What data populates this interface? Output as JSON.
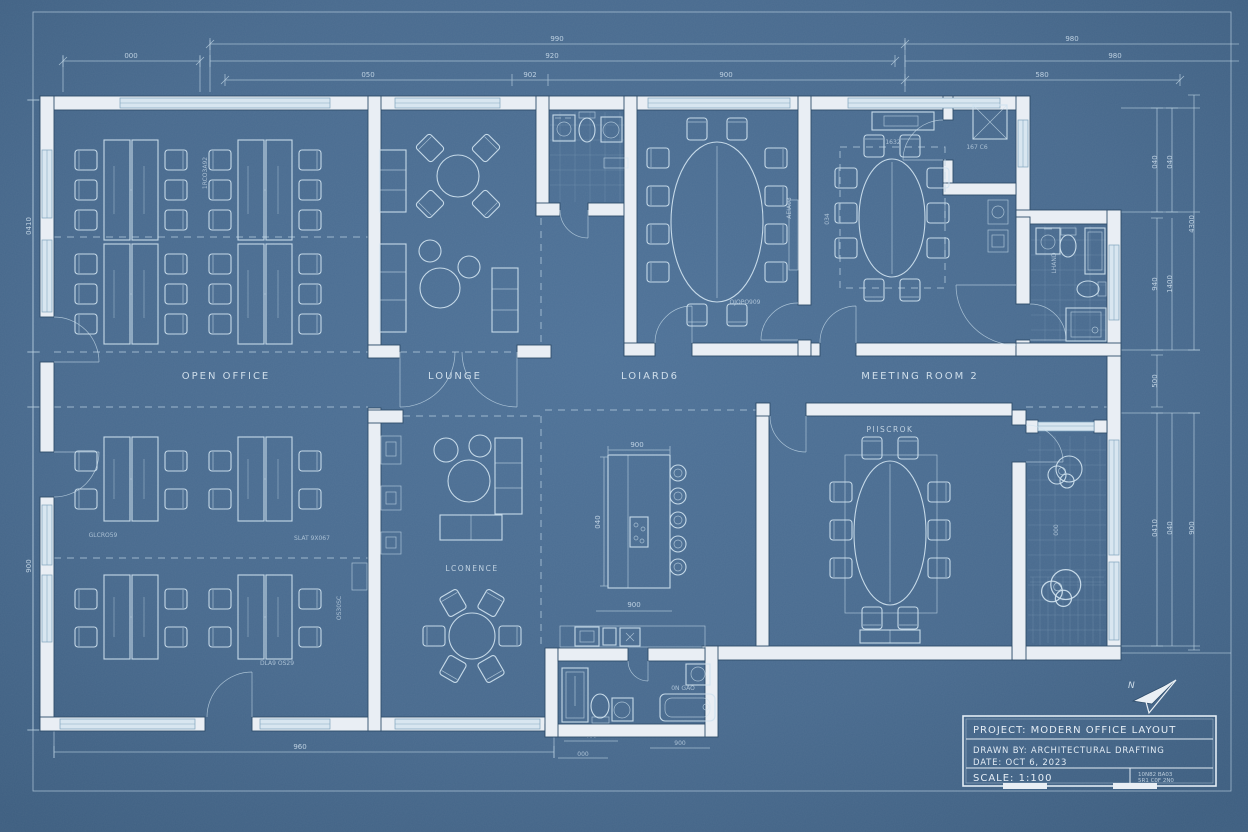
{
  "colors": {
    "background": "#486a8e",
    "wall": "#e9eef4",
    "line": "#cfe2ef",
    "dimension": "#b9d0e0",
    "window": "#d8e6f0",
    "text": "#dce9f3",
    "wall_outline": "#2f4d6b"
  },
  "rooms": {
    "open_office": "OPEN OFFICE",
    "lounge": "LOUNGE",
    "boardroom": "LOIARD6",
    "meeting_room_2": "MEETING ROOM 2",
    "meeting_room_3": "PIISCROK",
    "conference": "LCONENCE"
  },
  "title_block": {
    "project": "PROJECT: MODERN OFFICE LAYOUT",
    "drawn_by": "DRAWN BY: ARCHITECTURAL DRAFTING",
    "date": "DATE: OCT 6, 2023",
    "scale": "SCALE: 1:100",
    "stamp_line1": "10N82 BA03",
    "stamp_line2": "5R1 C0F 2N0"
  },
  "north_label": "N",
  "dims_top": [
    "990",
    "980",
    "000",
    "920",
    "980",
    "050",
    "902",
    "900",
    "580"
  ],
  "dims_right": [
    "040",
    "040",
    "4300",
    "940",
    "1400",
    "500",
    "0410",
    "040",
    "900"
  ],
  "dims_left": [
    "0410",
    "900"
  ],
  "dims_bottom": [
    "960",
    "400",
    "900",
    "000"
  ],
  "dims_inner": [
    "900",
    "900",
    "040",
    "1632",
    "034"
  ],
  "tags": [
    "GLCRO59",
    "SLAT 9X067",
    "DLA9 OS29",
    "OS30SC",
    "1RCO3A92",
    "OJOPO909",
    "AEIA03",
    "167 C6",
    "LHAND",
    "000",
    "0N GAO"
  ]
}
